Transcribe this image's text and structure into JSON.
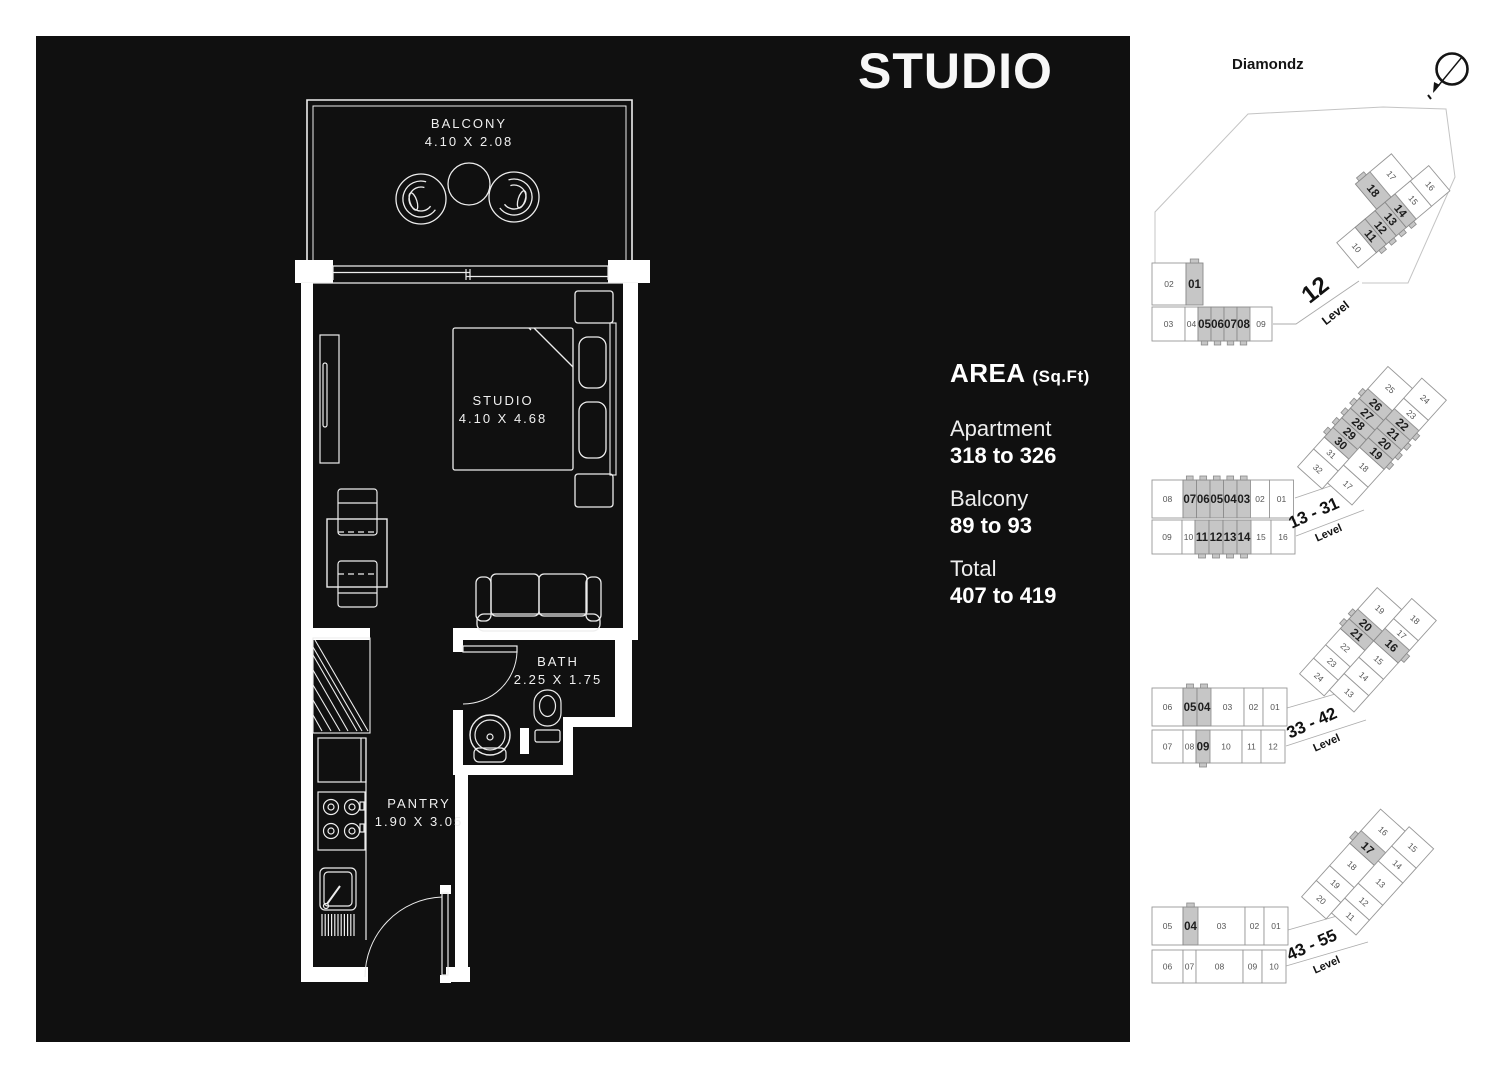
{
  "panel": {
    "title": "STUDIO"
  },
  "area": {
    "heading": "AREA",
    "unit": "(Sq.Ft)",
    "rows": [
      {
        "label": "Apartment",
        "value": "318 to 326"
      },
      {
        "label": "Balcony",
        "value": "89 to 93"
      },
      {
        "label": "Total",
        "value": "407 to 419"
      }
    ]
  },
  "floorplan": {
    "rooms": [
      {
        "name": "BALCONY",
        "dim": "4.10 X 2.08"
      },
      {
        "name": "STUDIO",
        "dim": "4.10 X 4.68"
      },
      {
        "name": "BATH",
        "dim": "2.25 X 1.75"
      },
      {
        "name": "PANTRY",
        "dim": "1.90 X 3.05"
      }
    ]
  },
  "sidebar": {
    "project": "Diamondz",
    "compass_icon": "north-compass-icon",
    "levels": [
      {
        "label": "12",
        "sub": "Level",
        "strip": [
          [
            "02",
            "01*"
          ],
          [
            "03",
            "04",
            "05*",
            "06*",
            "07*",
            "08*",
            "09"
          ]
        ],
        "wing": [
          [
            "18*",
            "17"
          ],
          [
            "10",
            "11*",
            "12*",
            "13*",
            "14*",
            "15",
            "16"
          ]
        ]
      },
      {
        "label": "13 - 31",
        "sub": "Level",
        "strip": [
          [
            "08",
            "07*",
            "06*",
            "05*",
            "04*",
            "03*",
            "02",
            "01"
          ],
          [
            "09",
            "10",
            "11*",
            "12*",
            "13*",
            "14*",
            "15",
            "16"
          ]
        ],
        "wing": [
          [
            "32",
            "31",
            "30*",
            "29*",
            "28*",
            "27*",
            "26*",
            "25"
          ],
          [
            "17",
            "18",
            "19*",
            "20*",
            "21*",
            "22*",
            "23",
            "24"
          ]
        ]
      },
      {
        "label": "33 - 42",
        "sub": "Level",
        "strip": [
          [
            "06",
            "05*",
            "04*",
            "03",
            "02",
            "01"
          ],
          [
            "07",
            "08",
            "09*",
            "10",
            "11",
            "12"
          ]
        ],
        "wing": [
          [
            "24",
            "23",
            "22",
            "21*",
            "20*",
            "19"
          ],
          [
            "13",
            "14",
            "15",
            "16*",
            "17",
            "18"
          ]
        ]
      },
      {
        "label": "43 - 55",
        "sub": "Level",
        "strip": [
          [
            "05",
            "04*",
            "03",
            "02",
            "01"
          ],
          [
            "06",
            "07",
            "08",
            "09",
            "10"
          ]
        ],
        "wing": [
          [
            "20",
            "19",
            "18",
            "17*",
            "16"
          ],
          [
            "11",
            "12",
            "13",
            "14",
            "15"
          ]
        ]
      }
    ]
  },
  "colors": {
    "panel_bg": "#101010",
    "plan_line": "#ededed",
    "highlight_unit": "#c6c6c6",
    "unit_stroke": "#979797",
    "text_light": "#f7f7f7"
  }
}
